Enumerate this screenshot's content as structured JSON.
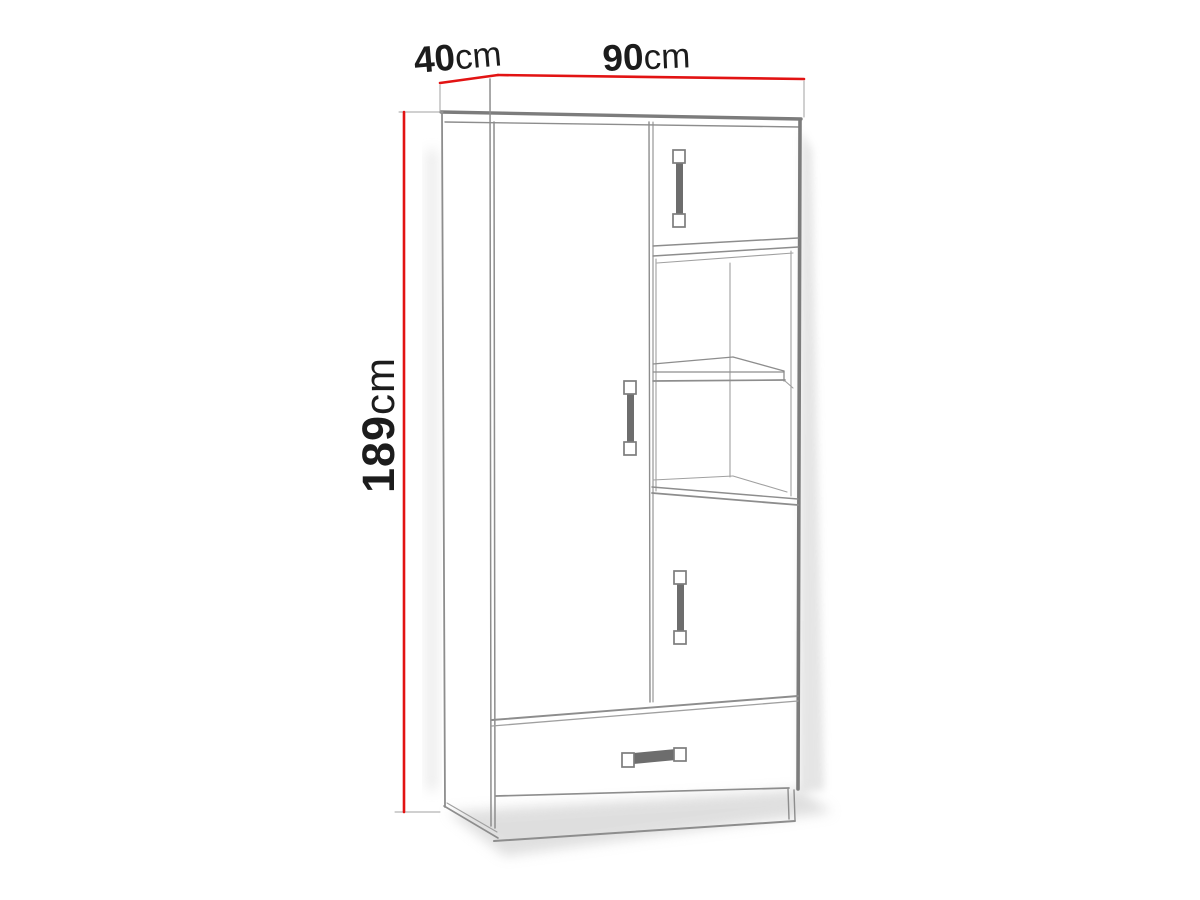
{
  "diagram": {
    "kind": "wardrobe-dimension-diagram",
    "dimensions": {
      "depth": {
        "value": "40",
        "unit": "cm"
      },
      "width": {
        "value": "90",
        "unit": "cm"
      },
      "height": {
        "value": "189",
        "unit": "cm"
      }
    },
    "colors": {
      "dimension_line": "#e21313",
      "outline": "#7c7c7c",
      "line_thin": "#8d8d8d",
      "line_light": "#a0a0a0",
      "handle": "#6d6d6d",
      "handle_cap_border": "#7c7c7c",
      "text": "#1c1c1c",
      "background": "#ffffff",
      "shadow": "#bfbfbf"
    }
  }
}
